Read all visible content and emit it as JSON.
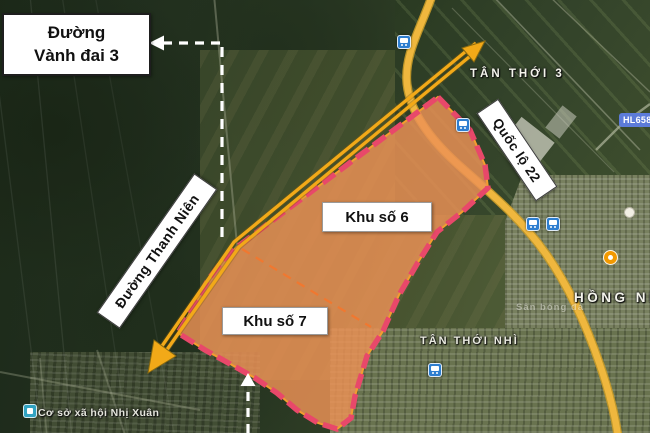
{
  "annotation_boxes": {
    "ring_road": {
      "line1": "Đường",
      "line2": "Vành đai 3"
    },
    "thanh_nien": {
      "label": "Đường Thanh Niên"
    },
    "khu6": {
      "label": "Khu số 6"
    },
    "khu7": {
      "label": "Khu số 7"
    },
    "ql22": {
      "label": "Quốc lộ 22"
    }
  },
  "map_labels": {
    "tan_thoi_3": "TÂN THỚI 3",
    "tan_thoi_nhi": "TÂN THỚI NHÌ",
    "hong_nha": "HỒNG NHÀ",
    "san_bong_da": "Sân bóng đá",
    "co_so_xa_hoi": "Cơ sở xã hội Nhị Xuân",
    "road_badge": "HL658"
  },
  "icons": {
    "bus_stop": "bus-front-glyph",
    "poi_orange": "filled-circle",
    "poi_white": "filled-circle",
    "co_so_poi": "community-building-glyph"
  },
  "colors": {
    "zone_fill": "#EC9259",
    "zone_border_pink": "#E8486A",
    "zone_divider_orange": "#F07830",
    "annotation_arrow_yellow": "#F2A918",
    "highway_yellow": "#EFB73E",
    "annotation_white": "#FFFFFF",
    "transit_blue": "#2E7ED0",
    "road_badge_blue": "#5C7BD9",
    "poi_orange": "#F29900"
  }
}
